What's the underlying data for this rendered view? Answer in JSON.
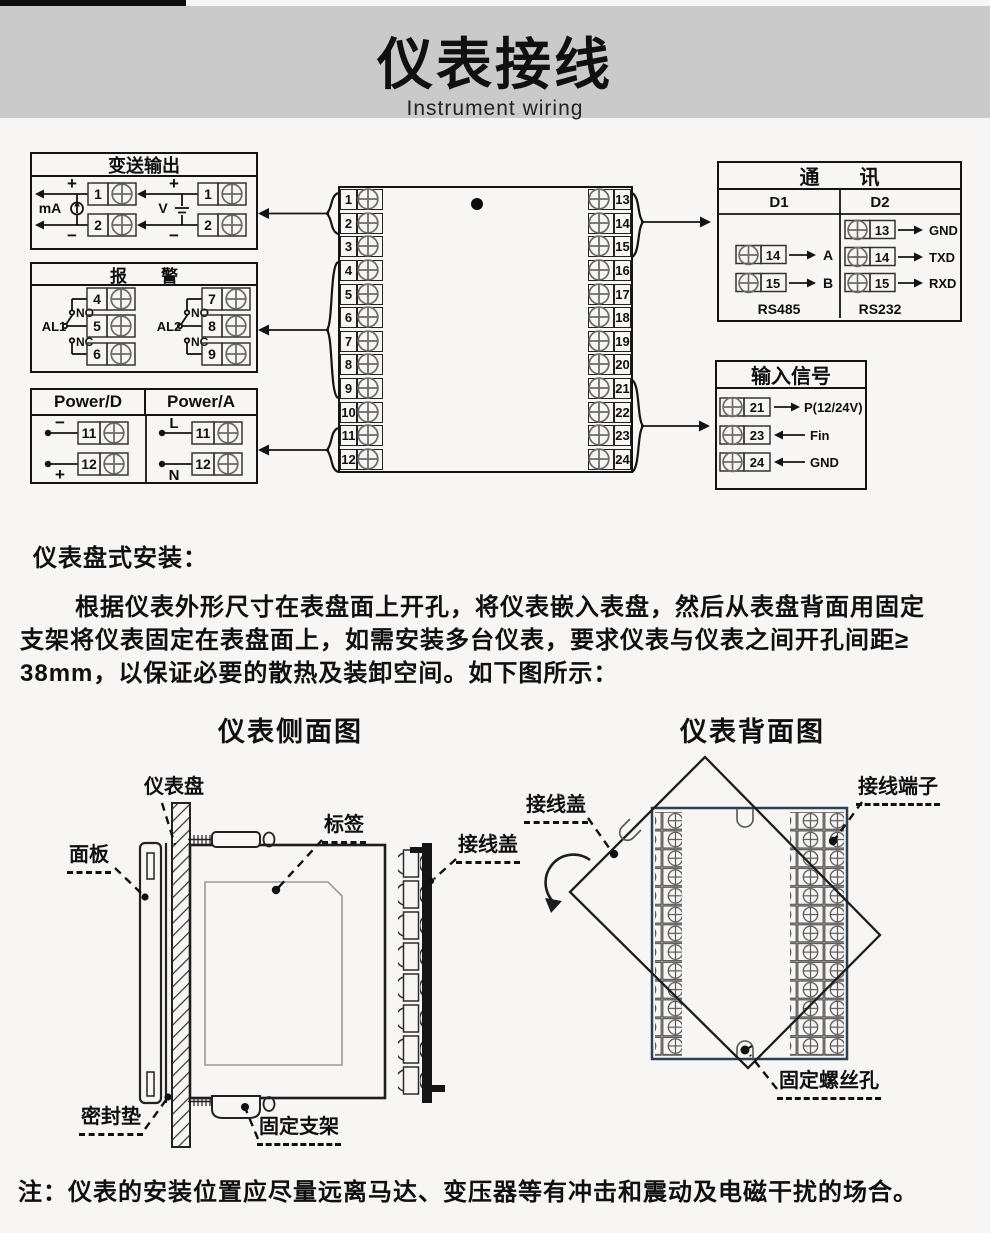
{
  "header": {
    "title": "仪表接线",
    "subtitle": "Instrument wiring"
  },
  "transmitter": {
    "title": "变送输出",
    "ma": "mA",
    "v": "V",
    "plus": "+",
    "minus": "−",
    "t1": "1",
    "t2": "2"
  },
  "alarm": {
    "title": "报　　警",
    "al1": "AL1",
    "al2": "AL2",
    "no": "NO",
    "nc": "NC",
    "t4": "4",
    "t5": "5",
    "t6": "6",
    "t7": "7",
    "t8": "8",
    "t9": "9"
  },
  "power": {
    "d_title": "Power/D",
    "a_title": "Power/A",
    "minus": "−",
    "plus": "+",
    "l": "L",
    "n": "N",
    "t11": "11",
    "t12": "12"
  },
  "terminal_block": {
    "left": [
      "1",
      "2",
      "3",
      "4",
      "5",
      "6",
      "7",
      "8",
      "9",
      "10",
      "11",
      "12"
    ],
    "right": [
      "13",
      "14",
      "15",
      "16",
      "17",
      "18",
      "19",
      "20",
      "21",
      "22",
      "23",
      "24"
    ]
  },
  "comm": {
    "title": "通　　讯",
    "d1": "D1",
    "d2": "D2",
    "rs485": "RS485",
    "rs232": "RS232",
    "d1_rows": [
      {
        "num": "14",
        "sig": "A"
      },
      {
        "num": "15",
        "sig": "B"
      }
    ],
    "d2_rows": [
      {
        "num": "13",
        "sig": "GND"
      },
      {
        "num": "14",
        "sig": "TXD"
      },
      {
        "num": "15",
        "sig": "RXD"
      }
    ]
  },
  "input": {
    "title": "输入信号",
    "rows": [
      {
        "num": "21",
        "sig": "P(12/24V)"
      },
      {
        "num": "23",
        "sig": "Fin"
      },
      {
        "num": "24",
        "sig": "GND"
      }
    ]
  },
  "install": {
    "heading": "仪表盘式安装：",
    "lines": [
      "根据仪表外形尺寸在表盘面上开孔，将仪表嵌入表盘，然后从表盘背面用固定",
      "支架将仪表固定在表盘面上，如需安装多台仪表，要求仪表与仪表之间开孔间距≥",
      "38mm，以保证必要的散热及装卸空间。如下图所示："
    ]
  },
  "side_view": {
    "caption": "仪表侧面图",
    "labels": {
      "panel": "仪表盘",
      "front": "面板",
      "tag": "标签",
      "cover": "接线盖",
      "gasket": "密封垫",
      "bracket": "固定支架"
    }
  },
  "back_view": {
    "caption": "仪表背面图",
    "labels": {
      "cover": "接线盖",
      "terminals": "接线端子",
      "screw_hole": "固定螺丝孔"
    }
  },
  "note": "注：仪表的安装位置应尽量远离马达、变压器等有冲击和震动及电磁干扰的场合。"
}
